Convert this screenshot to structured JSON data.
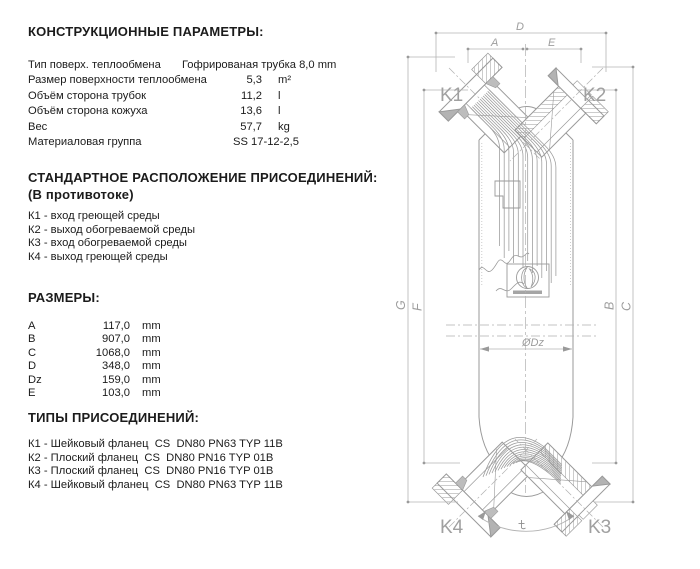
{
  "page": {
    "background": "#ffffff",
    "text_color": "#1b1b1b",
    "drawing_line_color": "#9a9a9a",
    "dimension_line_color": "#b4b4b4",
    "drawing_label_color": "#9d9d9d"
  },
  "sections": {
    "construction": {
      "title": "КОНСТРУКЦИОННЫЕ ПАРАМЕТРЫ:",
      "rows": [
        {
          "label": "Тип поверх. теплообмена",
          "value": "Гофрированая трубка 8,0 mm",
          "unit": ""
        },
        {
          "label": "Размер поверхности теплообмена",
          "value": "5,3",
          "unit": "m²"
        },
        {
          "label": "Объём сторона трубок",
          "value": "11,2",
          "unit": "l"
        },
        {
          "label": "Объём сторона кожуха",
          "value": "13,6",
          "unit": "l"
        },
        {
          "label": "Вес",
          "value": "57,7",
          "unit": "kg"
        },
        {
          "label": "Материаловая группа",
          "value": "SS 17-12-2,5",
          "unit": ""
        }
      ]
    },
    "arrangement": {
      "title": "СТАНДАРТНОЕ РАСПОЛОЖЕНИЕ ПРИСОЕДИНЕНИЙ:",
      "subtitle": "(В противотоке)",
      "items": [
        "К1 - вход греющей среды",
        "К2 - выход обогреваемой среды",
        "К3 - вход обогреваемой среды",
        "К4 - выход греющей среды"
      ]
    },
    "dimensions": {
      "title": "РАЗМЕРЫ:",
      "rows": [
        {
          "label": "A",
          "value": "117,0",
          "unit": "mm"
        },
        {
          "label": "B",
          "value": "907,0",
          "unit": "mm"
        },
        {
          "label": "C",
          "value": "1068,0",
          "unit": "mm"
        },
        {
          "label": "D",
          "value": "348,0",
          "unit": "mm"
        },
        {
          "label": "Dz",
          "value": "159,0",
          "unit": "mm"
        },
        {
          "label": "E",
          "value": "103,0",
          "unit": "mm"
        }
      ]
    },
    "connection_types": {
      "title": "ТИПЫ ПРИСОЕДИНЕНИЙ:",
      "items": [
        "К1 - Шейковый фланец  CS  DN80 PN63 TYP 11B",
        "К2 - Плоский фланец  CS  DN80 PN16 TYP 01B",
        "К3 - Плоский фланец  CS  DN80 PN16 TYP 01B",
        "К4 - Шейковый фланец  CS  DN80 PN63 TYP 11B"
      ]
    }
  },
  "drawing": {
    "labels": {
      "d": "D",
      "a": "A",
      "e": "E",
      "g": "G",
      "f": "F",
      "b": "B",
      "c": "C",
      "dz": "ØDz",
      "k1": "K1",
      "k2": "K2",
      "k3": "K3",
      "k4": "K4"
    }
  }
}
